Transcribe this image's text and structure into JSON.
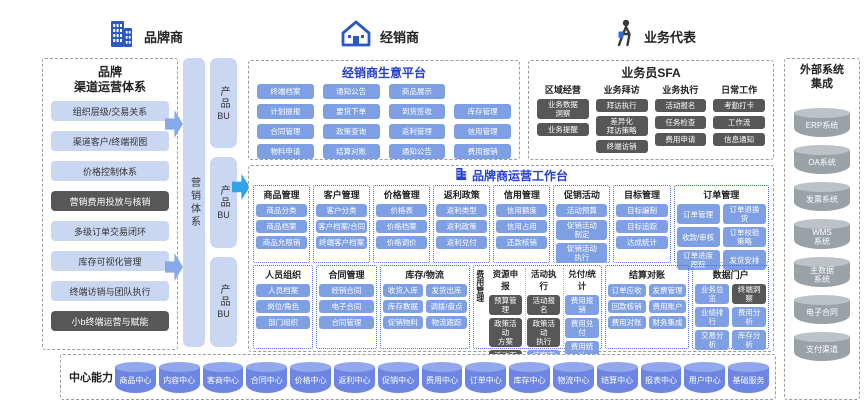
{
  "actors": [
    {
      "label": "品牌商",
      "icon": "building-icon"
    },
    {
      "label": "经销商",
      "icon": "home-icon"
    },
    {
      "label": "业务代表",
      "icon": "person-icon"
    }
  ],
  "left_panel": {
    "title1": "品牌",
    "title2": "渠道运营体系",
    "items": [
      "组织层级/交易关系",
      "渠道客户/终端视图",
      "价格控制体系",
      {
        "t": "营销费用投放与核销",
        "s": "dark"
      },
      "多级订单交易闭环",
      "库存可视化管理",
      "终端访销与团队执行",
      {
        "t": "小b终端运营与赋能",
        "s": "dark"
      }
    ]
  },
  "marketing": {
    "label": "营销体系"
  },
  "bu": {
    "items": [
      {
        "t": "产品",
        "e": "BU"
      },
      {
        "t": "产品",
        "e": "BU"
      },
      {
        "t": "产品",
        "e": "BU"
      }
    ]
  },
  "dealer": {
    "title": "经销商生意平台",
    "col1": [
      "终端档案",
      "计划提报",
      "合同管理",
      "物料申请"
    ],
    "col2": [
      "通知公告",
      "要货下单",
      "政策查询",
      "结算对账"
    ],
    "col3": [
      "商品展示",
      "到货签收",
      "返利管理",
      "通知公告"
    ],
    "col4": [
      "",
      "库存管理",
      "信用管理",
      "费用报销"
    ]
  },
  "sfa": {
    "title": "业务员SFA",
    "g1": {
      "header": "区域经营",
      "items": [
        "业务数据\n洞察",
        "业务提醒"
      ]
    },
    "g2": {
      "header": "业务拜访",
      "items": [
        "拜访执行",
        "差异化\n拜访策略",
        "终端访销"
      ]
    },
    "g3": {
      "header": "业务执行",
      "items": [
        "活动报名",
        "任务检查",
        "费用申请"
      ]
    },
    "g4": {
      "header": "日常工作",
      "items": [
        "考勤打卡",
        "工作流",
        "信息通知"
      ]
    }
  },
  "workbench": {
    "title": "品牌商运营工作台",
    "g1": {
      "header": "商品管理",
      "items": [
        "商品分类",
        "商品档案",
        "商品允限销"
      ]
    },
    "g2": {
      "header": "客户管理",
      "items": [
        "客户分类",
        "客户档案/合同",
        "终端客户档案"
      ]
    },
    "g3": {
      "header": "价格管理",
      "items": [
        "价格表",
        "价格档案",
        "价格调价"
      ]
    },
    "g4": {
      "header": "返利政策",
      "items": [
        "返利类型",
        "返利政策",
        "返利兑付"
      ]
    },
    "g5": {
      "header": "信用管理",
      "items": [
        "信用额度",
        "信用占用",
        "还款核销"
      ]
    },
    "g6": {
      "header": "促销活动",
      "items": [
        "活动预算",
        "促销活动\n制定",
        "促销活动\n执行"
      ]
    },
    "g7": {
      "header": "目标管理",
      "items": [
        "目标编制",
        "目标追踪",
        "达成统计"
      ]
    },
    "g8": {
      "header": "订单管理",
      "items": [
        "订单管理",
        "订单退换\n货",
        "收款/审核",
        "订单校验\n策略",
        "订单进度\n跟踪",
        "发货安排"
      ]
    },
    "h1": {
      "header": "人员组织",
      "items": [
        "人员档案",
        "岗位/角色",
        "部门组织"
      ]
    },
    "h2": {
      "header": "合同管理",
      "items": [
        "经销合同",
        "电子合同",
        "合同管理"
      ]
    },
    "h3": {
      "header": "库存/物流",
      "items": [
        "收货入库",
        "发货出库",
        "库存数据",
        "调拨/盘点",
        "促销物料",
        "物流跟踪"
      ]
    },
    "fee": {
      "label": "费用管理",
      "sub1": {
        "header": "资源申报",
        "items": [
          {
            "t": "预算管理",
            "s": "dark"
          },
          {
            "t": "政策活动\n方案",
            "s": "dark"
          },
          {
            "t": "活动下发",
            "s": "dark"
          }
        ]
      },
      "sub2": {
        "header": "活动执行",
        "items": [
          {
            "t": "活动报名",
            "s": "dark"
          },
          {
            "t": "政策活动\n执行",
            "s": "dark"
          },
          "结案审核"
        ]
      },
      "sub3": {
        "header": "兑付/统计",
        "items": [
          "费用报销",
          "费用兑付",
          "费用统计"
        ]
      }
    },
    "h5": {
      "header": "结算对账",
      "items": [
        "订单应收",
        "发票管理",
        "回款核销",
        "费用账户",
        "费用对账",
        "财务集成"
      ]
    },
    "h6": {
      "header": "数据门户",
      "items": [
        "业务总览",
        {
          "t": "终端洞察",
          "s": "dark"
        },
        "业绩排行",
        "费用分析",
        "交易分析",
        "库存分析"
      ]
    }
  },
  "external": {
    "title": "外部系统\n集成",
    "systems": [
      "ERP系统",
      "OA系统",
      "发票系统",
      "WMS\n系统",
      "主数据\n系统",
      "电子合同",
      "支付渠道"
    ]
  },
  "centers": {
    "label": "中心能力",
    "items": [
      "商品中心",
      "内容中心",
      "客商中心",
      "合同中心",
      "价格中心",
      "返利中心",
      "促销中心",
      "费用中心",
      "订单中心",
      "库存中心",
      "物流中心",
      "结算中心",
      "报表中心",
      "用户中心",
      "基础服务"
    ]
  },
  "colors": {
    "module_blue": "#7f9fe4",
    "dark_gray": "#575757",
    "light_blue": "#cad7f2",
    "title_blue": "#2540d0",
    "cylinder_blue": "#6d86e4",
    "cylinder_gray": "#9aa1a7",
    "arrow_blue": "#86a9ea",
    "arrow_bright": "#2ea4ec"
  }
}
